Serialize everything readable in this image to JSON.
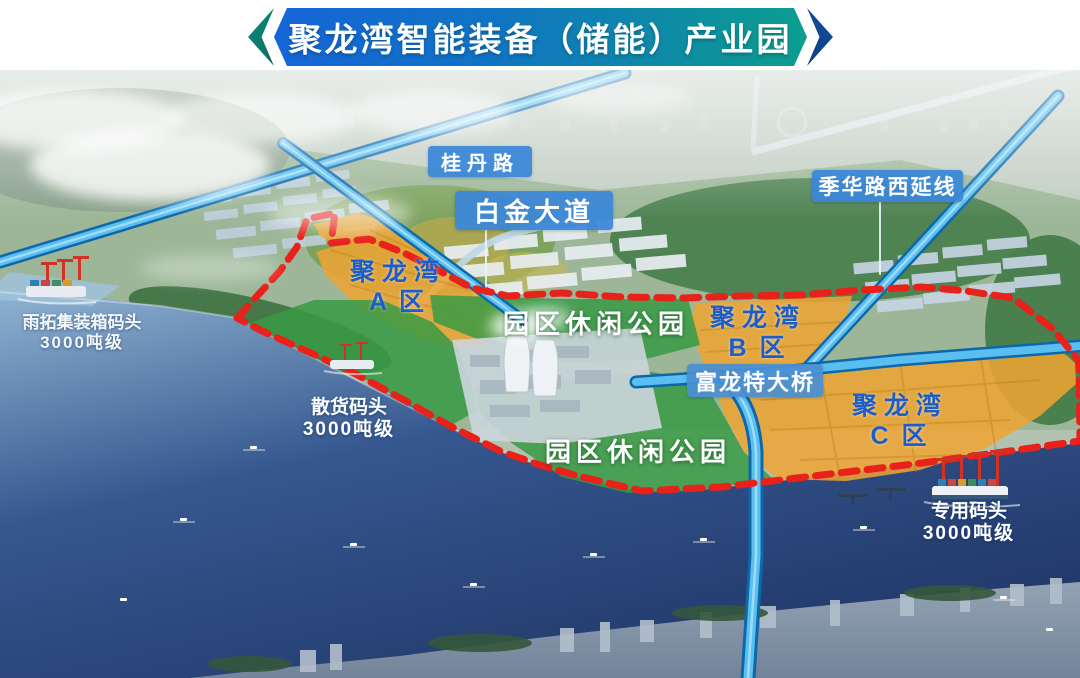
{
  "banner": {
    "title": "聚龙湾智能装备（储能）产业园"
  },
  "road_labels": {
    "guidan": "桂丹路",
    "baijin": "白金大道",
    "jihua": "季华路西延线",
    "fulong": "富龙特大桥"
  },
  "zones": [
    {
      "name": "聚龙湾",
      "district": "A 区"
    },
    {
      "name": "聚龙湾",
      "district": "B 区"
    },
    {
      "name": "聚龙湾",
      "district": "C 区"
    }
  ],
  "parks": [
    {
      "label": "园区休闲公园"
    },
    {
      "label": "园区休闲公园"
    }
  ],
  "docks": [
    {
      "name": "雨拓集装箱码头",
      "tonnage": "3000吨级"
    },
    {
      "name": "散货码头",
      "tonnage": "3000吨级"
    },
    {
      "name": "专用码头",
      "tonnage": "3000吨级"
    }
  ],
  "colors": {
    "banner_gradient_start": "#1565d8",
    "banner_gradient_end": "#0b9e8e",
    "road_label_bg": "#3a86d8",
    "zone_label_text": "#1b5ec9",
    "zone_fill_orange": "#f0a432",
    "park_fill_green": "#389a44",
    "boundary_red": "#e8211a",
    "road_blue": "#58bff0",
    "water_blue": "#2c4e86"
  }
}
